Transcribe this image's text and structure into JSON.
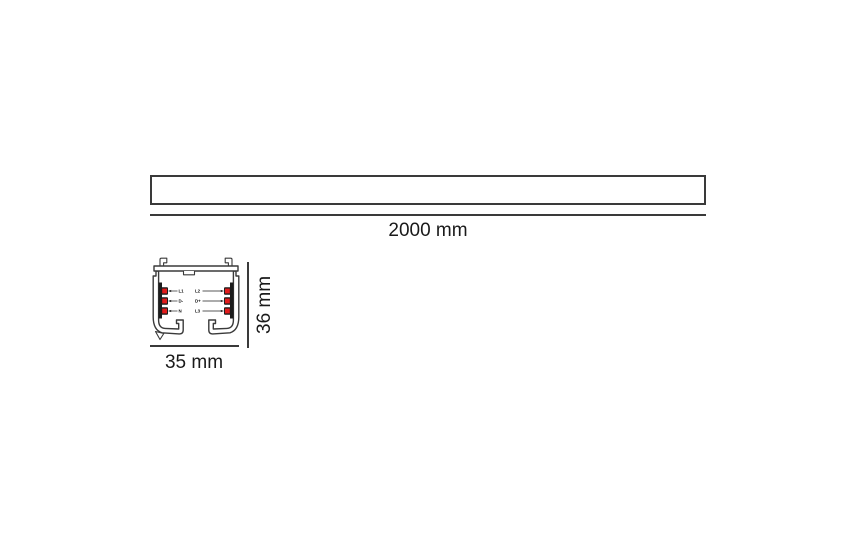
{
  "diagram": {
    "side_view": {
      "length_dimension": "2000 mm"
    },
    "cross_section": {
      "width_dimension": "35 mm",
      "height_dimension": "36 mm",
      "conductors_left": [
        "L1",
        "D-",
        "N"
      ],
      "conductors_right": [
        "L2",
        "D+",
        "L3"
      ]
    },
    "colors": {
      "line": "#3a3a3a",
      "contact_red": "#e21b1b",
      "insulator_black": "#1c1c1c",
      "text": "#1a1a1a"
    }
  }
}
